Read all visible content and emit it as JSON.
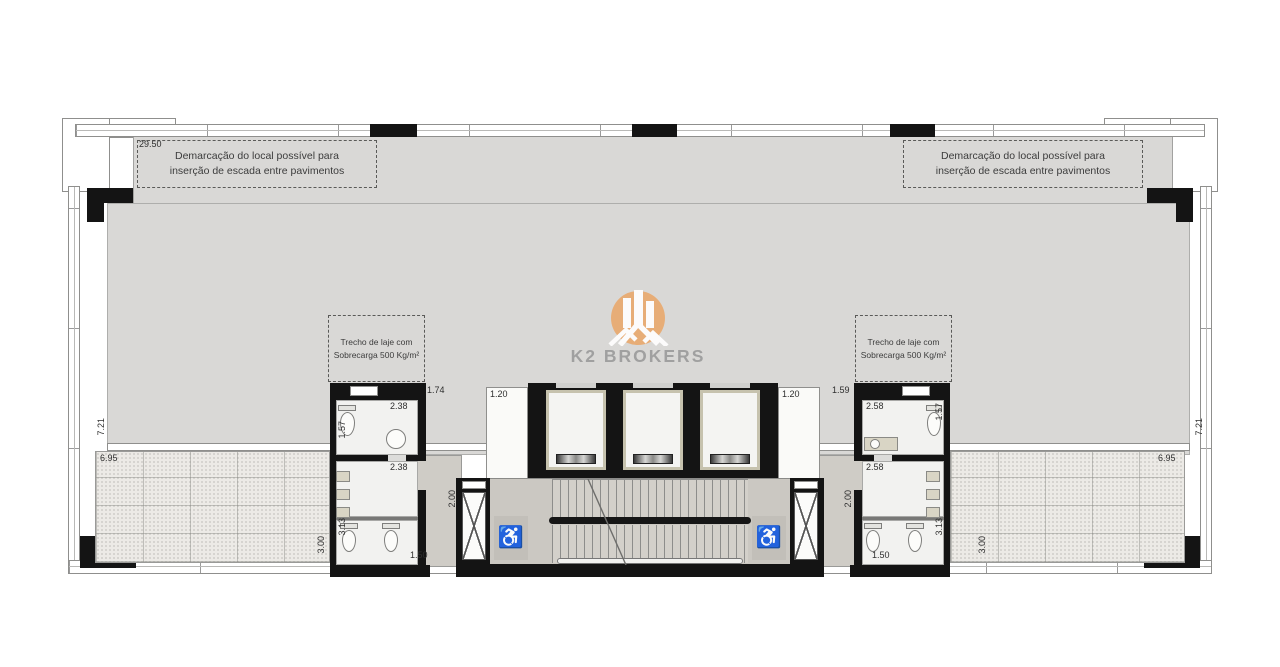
{
  "plan": {
    "title": "Pavimento - planta (K2 Brokers)",
    "notes": {
      "stair_demarcation_l1": "Demarcação do local possível para",
      "stair_demarcation_l2": "inserção de escada entre pavimentos",
      "slab_l1": "Trecho de laje com",
      "slab_l2": "Sobrecarga 500 Kg/m²"
    },
    "dims": {
      "overall": "29.50",
      "side_depth": "7.21",
      "terrace_depth": "6.95",
      "lobby": "1.20",
      "bl_top": "1.74",
      "bl_w_top": "2.38",
      "bl_h_top": "1.57",
      "bl_w_mid": "2.38",
      "bl_h_bot": "3.13",
      "bl_depth": "3.00",
      "bl_corr_h": "2.00",
      "bl_corr_w": "1.50",
      "br_top": "1.59",
      "br_w_top": "2.58",
      "br_h_top": "1.57",
      "br_w_mid": "2.58",
      "br_h_bot": "3.13",
      "br_depth": "3.00",
      "br_corr_h": "2.00",
      "br_corr_w": "1.50"
    },
    "symbols": {
      "wheelchair": "♿"
    },
    "watermark": {
      "brand": "K2 BROKERS"
    },
    "colors": {
      "logo_orange": "#E9AA70",
      "brand_gray": "#9C9C9C",
      "wall_black": "#141414",
      "floor_gray": "#D9D8D6",
      "stair_floor": "#CBC8C2",
      "tile_floor": "#ECEAE6"
    }
  }
}
